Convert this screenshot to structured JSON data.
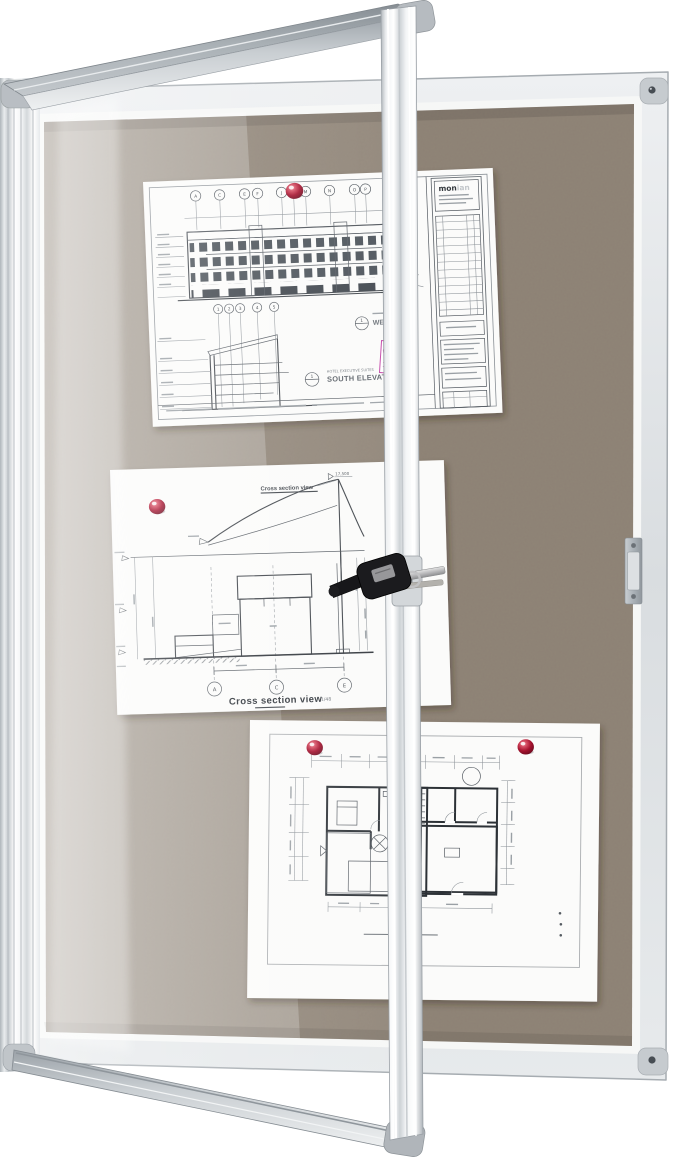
{
  "scene": {
    "object": "lockable felt notice board with open glass door, key in lock, three pinned architectural drawings",
    "pin_count": "4"
  },
  "colors": {
    "felt": "#8d8275",
    "felt_lit": "#a89f92",
    "frame_aluminum": "#dfe3e6",
    "door_rail": "#a4abb1",
    "push_pin": "#a5122e",
    "stamp_magenta": "#c445a8",
    "drawing_ink": "#41464c",
    "paper": "#fbfbfa"
  },
  "elevation_sheet": {
    "grid_letters": [
      "A",
      "C",
      "E",
      "F",
      "J",
      "M",
      "N",
      "O",
      "P"
    ],
    "grid_numbers": [
      "1",
      "2",
      "3",
      "4",
      "5"
    ],
    "west_title": "WEST E",
    "west_marker": "1",
    "south_caption": "HOTEL EXECUTIVE SUITES",
    "south_title": "SOUTH ELEVATION",
    "south_marker": "1",
    "logo_bold": "mon",
    "logo_light": "ian"
  },
  "section_sheet": {
    "header": "Cross section view",
    "peak_label": "17,500",
    "grid_bubbles": [
      "A",
      "C",
      "E"
    ],
    "title": "Cross section view",
    "scale": "1/48"
  }
}
